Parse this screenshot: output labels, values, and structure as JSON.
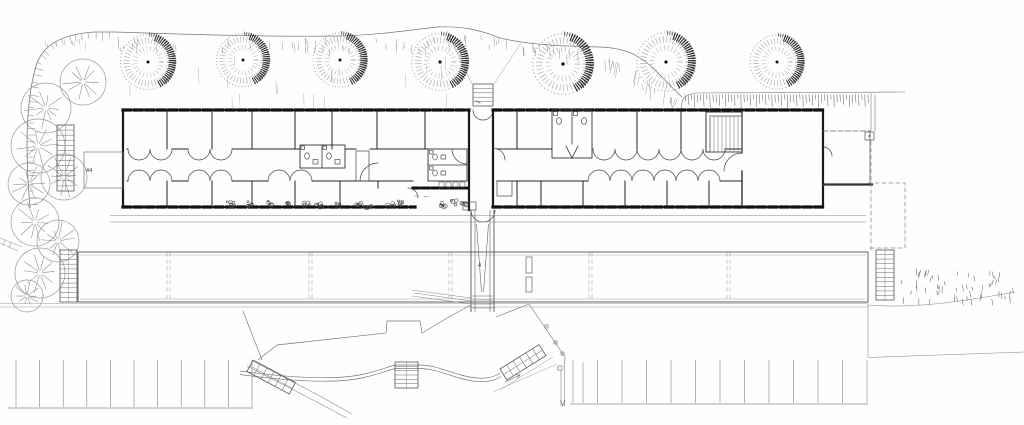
{
  "palette": {
    "paper": "#fefefe",
    "ink": "#1a1a1a",
    "wall": "#222222",
    "thin": "#777777",
    "faint": "#999999"
  },
  "annotations": [
    {
      "text": "44",
      "x": 86,
      "y": 172
    },
    {
      "text": "4",
      "x": 478,
      "y": 267
    }
  ],
  "site": {
    "stippled_trees": [
      {
        "x": 148,
        "y": 62,
        "s": 1.02
      },
      {
        "x": 243,
        "y": 60,
        "s": 0.98
      },
      {
        "x": 340,
        "y": 60,
        "s": 1.0
      },
      {
        "x": 440,
        "y": 62,
        "s": 1.05
      },
      {
        "x": 563,
        "y": 64,
        "s": 1.12
      },
      {
        "x": 666,
        "y": 62,
        "s": 1.08
      },
      {
        "x": 777,
        "y": 62,
        "s": 1.0
      }
    ],
    "line_trees": [
      {
        "x": 83,
        "y": 82,
        "r": 23
      },
      {
        "x": 46,
        "y": 108,
        "r": 25
      },
      {
        "x": 38,
        "y": 146,
        "r": 27
      },
      {
        "x": 64,
        "y": 177,
        "r": 23
      },
      {
        "x": 29,
        "y": 184,
        "r": 21
      },
      {
        "x": 35,
        "y": 222,
        "r": 24
      },
      {
        "x": 58,
        "y": 241,
        "r": 21
      },
      {
        "x": 40,
        "y": 273,
        "r": 25
      },
      {
        "x": 27,
        "y": 296,
        "r": 16
      }
    ],
    "parking_left": {
      "x_start": 16,
      "x_end": 252,
      "y_top": 360,
      "y_bottom": 407,
      "stall_lines": 11,
      "base_x0": 8,
      "base_x1": 253,
      "base_y": 408
    },
    "parking_right": {
      "x_start": 573,
      "x_end": 867,
      "y_top": 360,
      "y_bottom": 403,
      "stall_lines": 13,
      "base_x0": 570,
      "base_x1": 868,
      "base_y": 404
    },
    "terrace_joints": [
      168,
      310,
      450,
      590,
      728
    ],
    "shrubs": [
      [
        231,
        204
      ],
      [
        249,
        204
      ],
      [
        270,
        203
      ],
      [
        288,
        204
      ],
      [
        308,
        205
      ],
      [
        320,
        206
      ],
      [
        337,
        204
      ],
      [
        358,
        204
      ],
      [
        368,
        206
      ],
      [
        391,
        205
      ],
      [
        401,
        203
      ],
      [
        443,
        205
      ],
      [
        455,
        203
      ],
      [
        464,
        205
      ]
    ],
    "benches": [
      [
        526,
        257,
        6,
        16
      ],
      [
        526,
        277,
        6,
        15
      ]
    ]
  }
}
